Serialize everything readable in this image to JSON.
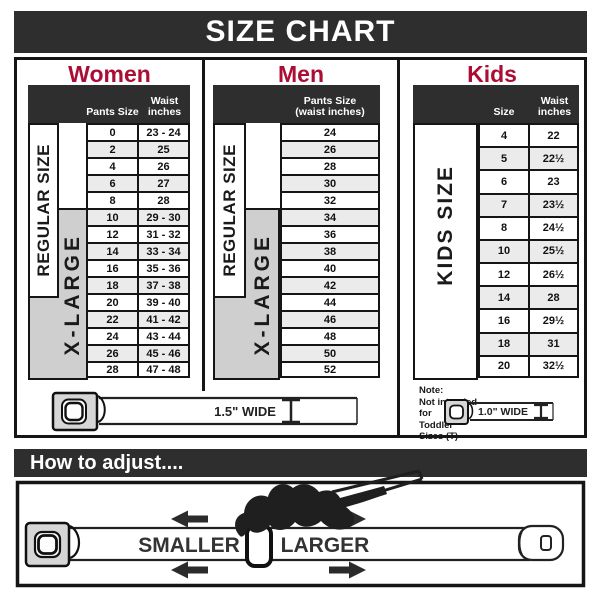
{
  "header": {
    "title": "SIZE CHART"
  },
  "sections": {
    "women": {
      "title": "Women",
      "columns": [
        "Pants Size",
        "Waist inches"
      ],
      "size_labels": [
        "REGULAR SIZE",
        "X-LARGE"
      ],
      "rows": [
        [
          "0",
          "23 - 24"
        ],
        [
          "2",
          "25"
        ],
        [
          "4",
          "26"
        ],
        [
          "6",
          "27"
        ],
        [
          "8",
          "28"
        ],
        [
          "10",
          "29 - 30"
        ],
        [
          "12",
          "31 - 32"
        ],
        [
          "14",
          "33 - 34"
        ],
        [
          "16",
          "35 - 36"
        ],
        [
          "18",
          "37 - 38"
        ],
        [
          "20",
          "39 - 40"
        ],
        [
          "22",
          "41 - 42"
        ],
        [
          "24",
          "43 - 44"
        ],
        [
          "26",
          "45 - 46"
        ],
        [
          "28",
          "47 - 48"
        ]
      ]
    },
    "men": {
      "title": "Men",
      "columns": [
        "Pants Size (waist inches)"
      ],
      "size_labels": [
        "REGULAR SIZE",
        "X-LARGE"
      ],
      "rows": [
        "24",
        "26",
        "28",
        "30",
        "32",
        "34",
        "36",
        "38",
        "40",
        "42",
        "44",
        "46",
        "48",
        "50",
        "52"
      ]
    },
    "kids": {
      "title": "Kids",
      "columns": [
        "Size",
        "Waist inches"
      ],
      "size_label": "KIDS SIZE",
      "note": [
        "Note:",
        "Not intended for",
        "Toddler Sizes (T)"
      ],
      "rows": [
        [
          "4",
          "22"
        ],
        [
          "5",
          "22½"
        ],
        [
          "6",
          "23"
        ],
        [
          "7",
          "23½"
        ],
        [
          "8",
          "24½"
        ],
        [
          "10",
          "25½"
        ],
        [
          "12",
          "26½"
        ],
        [
          "14",
          "28"
        ],
        [
          "16",
          "29½"
        ],
        [
          "18",
          "31"
        ],
        [
          "20",
          "32½"
        ]
      ]
    }
  },
  "belts": {
    "adult": {
      "width_label": "1.5\" WIDE"
    },
    "kids": {
      "width_label": "1.0\" WIDE"
    }
  },
  "adjust": {
    "title": "How to adjust....",
    "smaller_label": "SMALLER",
    "larger_label": "LARGER"
  },
  "colors": {
    "accent_red": "#ac0d35",
    "bar_dark": "#2e2e2e",
    "row_alt": "#ebebeb",
    "panel_gray": "#cfcfcf",
    "border": "#151515"
  }
}
